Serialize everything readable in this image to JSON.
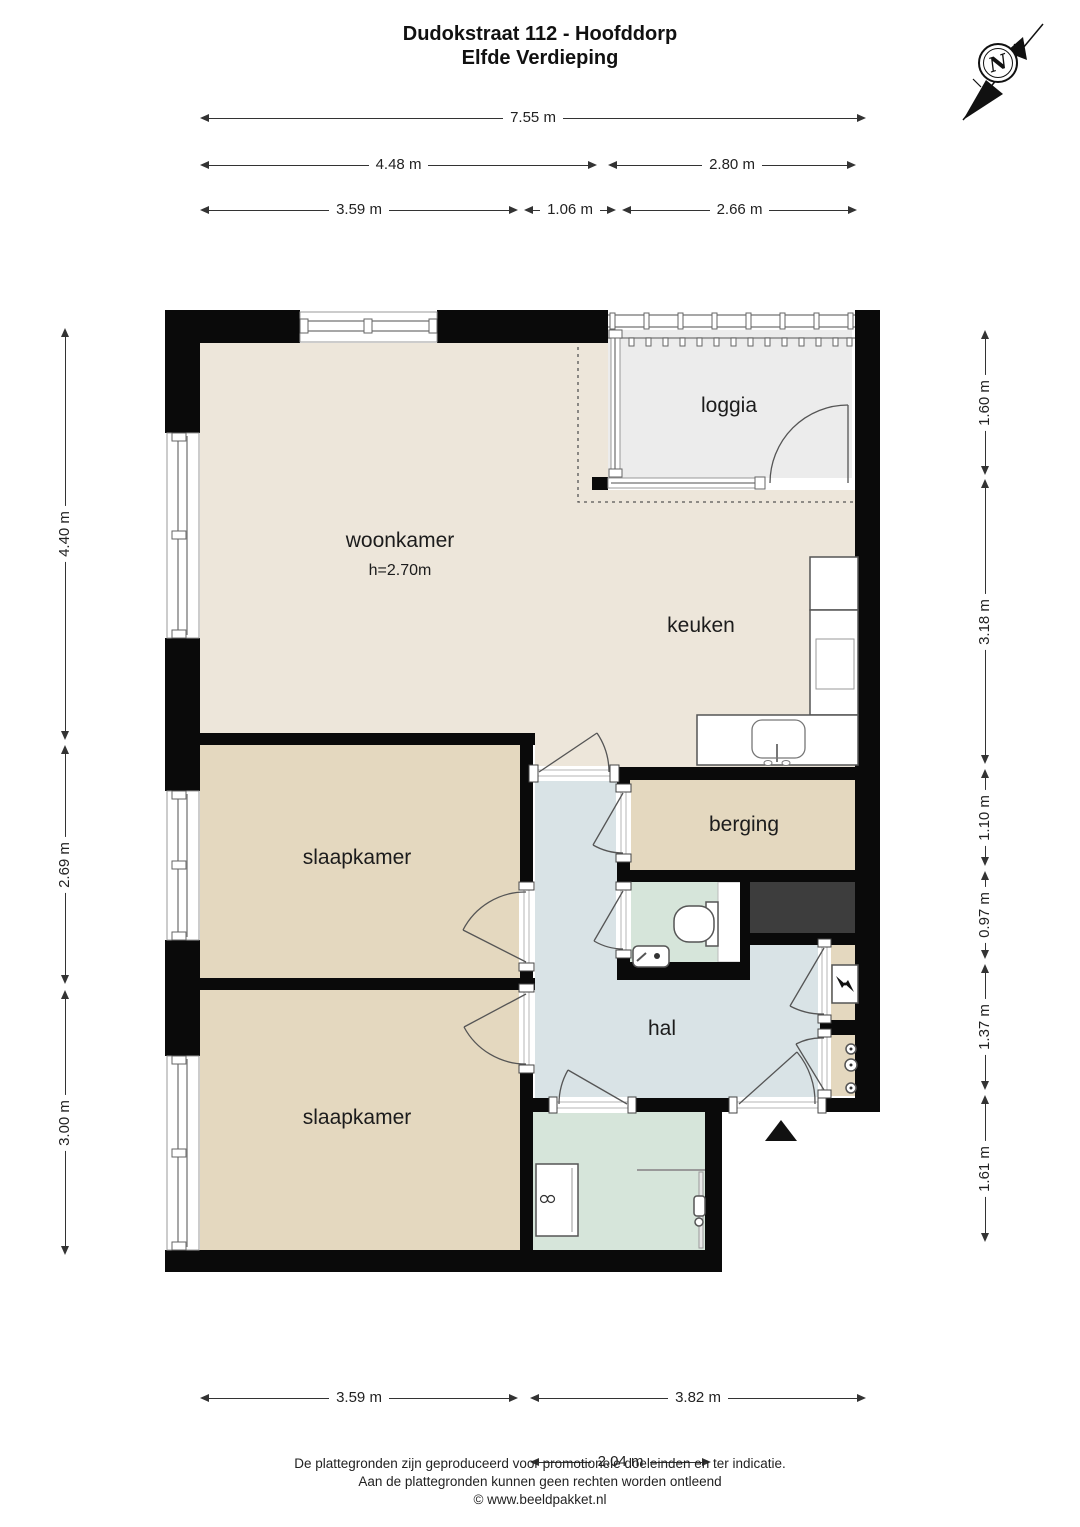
{
  "title": {
    "line1": "Dudokstraat 112 - Hoofddorp",
    "line2": "Elfde Verdieping"
  },
  "compass": {
    "letter": "N"
  },
  "rooms": {
    "woonkamer": {
      "label": "woonkamer",
      "ceiling_height": "h=2.70m"
    },
    "keuken": {
      "label": "keuken"
    },
    "loggia": {
      "label": "loggia"
    },
    "berging": {
      "label": "berging"
    },
    "hal": {
      "label": "hal"
    },
    "slaapkamer1": {
      "label": "slaapkamer"
    },
    "slaapkamer2": {
      "label": "slaapkamer"
    }
  },
  "dimensions": {
    "top": [
      "7.55 m",
      "4.48 m",
      "2.80 m",
      "3.59 m",
      "1.06 m",
      "2.66 m"
    ],
    "left": [
      "4.40 m",
      "2.69 m",
      "3.00 m"
    ],
    "right": [
      "1.60 m",
      "3.18 m",
      "1.10 m",
      "0.97 m",
      "1.37 m",
      "1.61 m"
    ],
    "bottom": [
      "3.59 m",
      "3.82 m",
      "2.04 m"
    ]
  },
  "footer": {
    "line1": "De plattegronden zijn geproduceerd voor promotionele doeleinden en ter indicatie.",
    "line2": "Aan de plattegronden kunnen geen rechten worden ontleend",
    "line3": "© www.beeldpakket.nl"
  },
  "colors": {
    "wall": "#0a0a0a",
    "floor-woonkamer": "#ede6da",
    "floor-slaapkamer": "#e4d8bf",
    "floor-hal": "#d9e3e6",
    "floor-bad": "#d6e5da",
    "floor-loggia": "#ececec",
    "shaft": "#3d3d3d",
    "line": "#333333"
  }
}
